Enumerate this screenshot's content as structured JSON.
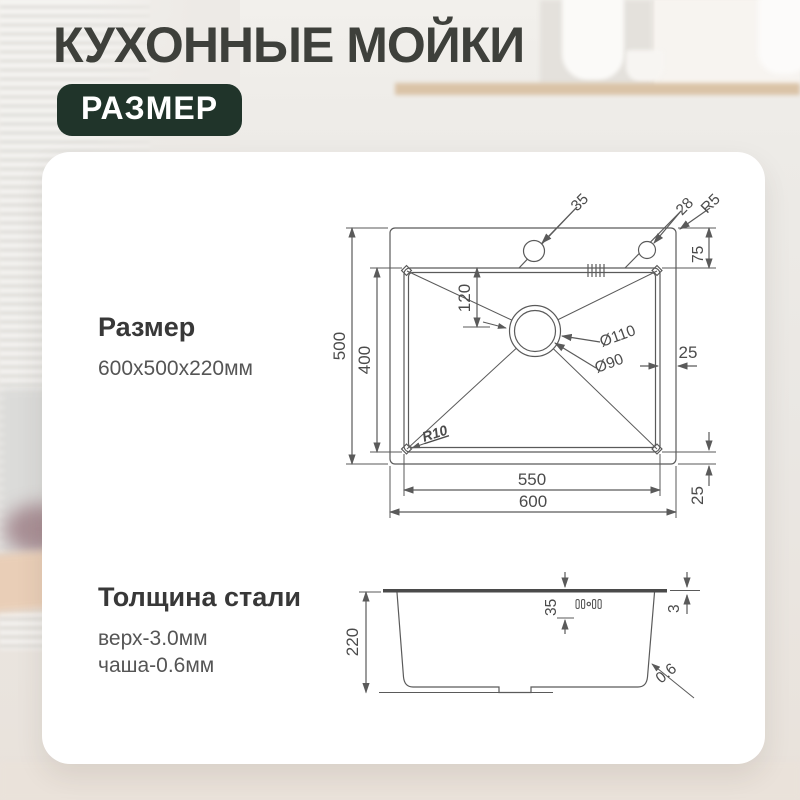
{
  "header": {
    "title": "КУХОННЫЕ МОЙКИ",
    "badge": "РАЗМЕР"
  },
  "card": {
    "size_section": {
      "title": "Размер",
      "value": "600x500x220мм"
    },
    "thickness_section": {
      "title": "Толщина стали",
      "rows": [
        "верх-3.0мм",
        "чаша-0.6мм"
      ]
    }
  },
  "drawing": {
    "top_view": {
      "total_width": "600",
      "total_height": "500",
      "bowl_width": "550",
      "bowl_height": "400",
      "hole_left_diameter": "35",
      "hole_right_diameter": "28",
      "outer_corner_radius": "R5",
      "top_deck_offset": "75",
      "drain_offset": "120",
      "drain_outer_diameter": "Ø110",
      "drain_inner_diameter": "Ø90",
      "right_gap": "25",
      "bottom_gap": "25",
      "bowl_corner_radius": "R10"
    },
    "side_view": {
      "depth": "220",
      "rim_drop": "35",
      "top_thickness": "3",
      "wall_thickness": "0.6"
    }
  },
  "colors": {
    "badge_bg": "#20342a",
    "title_color": "#3e403b",
    "line_color": "#5a5a5a",
    "dim_color": "#4b4b4b"
  }
}
